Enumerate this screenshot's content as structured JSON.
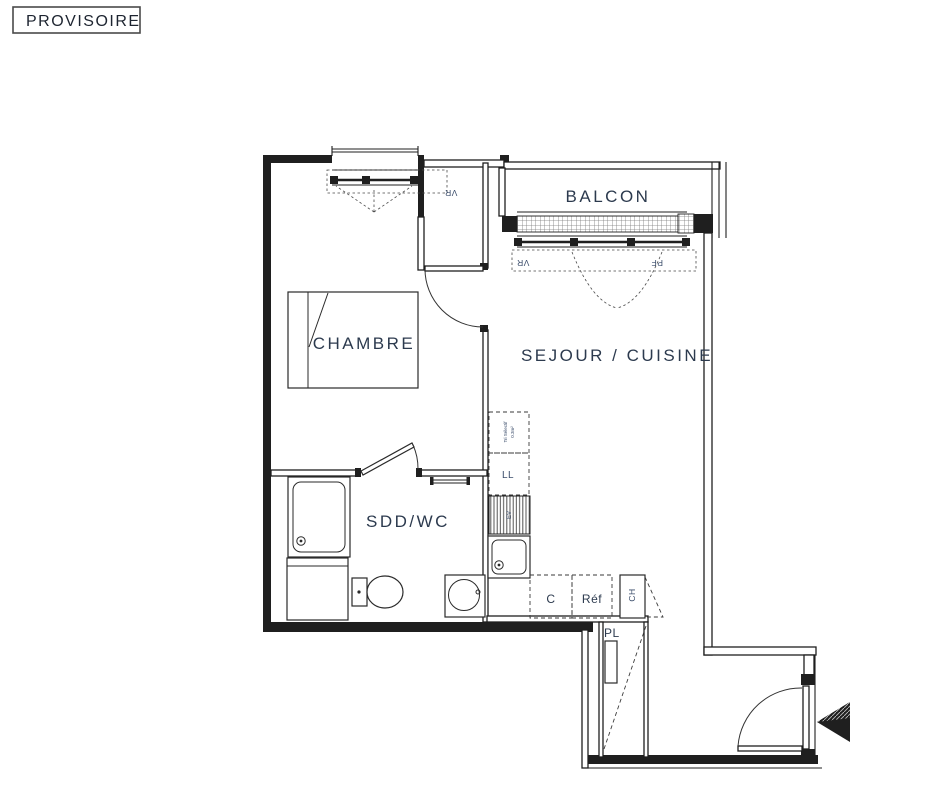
{
  "status_stamp": {
    "label": "PROVISOIRE"
  },
  "rooms": {
    "balcony": "BALCON",
    "bedroom": "CHAMBRE",
    "living_kitchen": "SEJOUR / CUISINE",
    "shower_wc": "SDD/WC",
    "closet": "PL"
  },
  "appliances": {
    "washing_machine": "LL",
    "sink_worktop": "EV",
    "cooker": "C",
    "fridge": "Réf",
    "water_heater": "CH"
  },
  "window_labels": {
    "roller_shutter": "VR",
    "french_window": "PF"
  },
  "annotations": {
    "waste_sorting_line1": "Tri Sélectif",
    "waste_sorting_line2": "0.3m²"
  },
  "colors": {
    "line": "#1f1f1f",
    "label": "#2c3a4e",
    "small_label": "#3b4d6b",
    "background": "#ffffff"
  }
}
